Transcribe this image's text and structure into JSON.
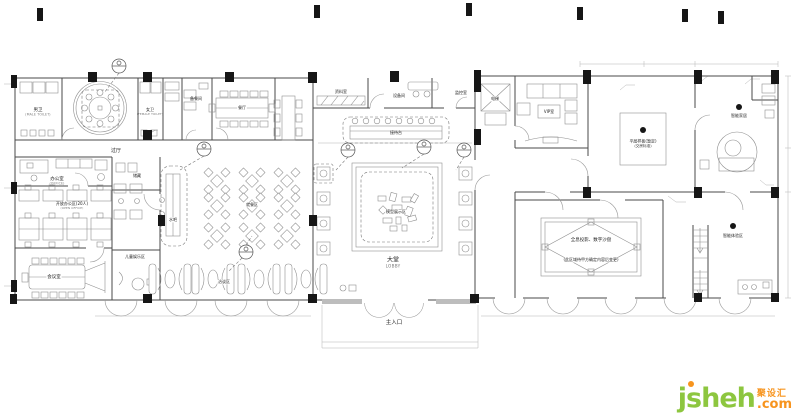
{
  "watermark": {
    "brand": "jsheh",
    "domain_suffix": ".com",
    "cn_name": "聚设汇",
    "green": "#8dc63f",
    "orange": "#f7941e"
  },
  "plan": {
    "rooms": {
      "male_toilet": {
        "zh": "男卫",
        "en": "(MALE TOILET)"
      },
      "female_toilet": {
        "zh": "女卫",
        "en": "(FEMALE TOILET)"
      },
      "pantry": {
        "zh": "备餐间"
      },
      "dining_room": {
        "zh": "餐厅"
      },
      "hall": {
        "zh": "过厅"
      },
      "office": {
        "zh": "办公室",
        "en": "(OFFICE)"
      },
      "open_office": {
        "zh": "开放办公区(20人)",
        "en": "(OPEN OFFICE)"
      },
      "meeting_room": {
        "zh": "会议室"
      },
      "storage": {
        "zh": "储藏"
      },
      "water_bar": {
        "zh": "水吧"
      },
      "kids_area": {
        "zh": "儿童娱乐区"
      },
      "dining_area": {
        "zh": "就餐区"
      },
      "booth_area": {
        "zh": "洽谈区"
      },
      "archive_room": {
        "zh": "资料室"
      },
      "equipment_room": {
        "zh": "设备间"
      },
      "monitor_room": {
        "zh": "监控室"
      },
      "elevator": {
        "zh": "电梯"
      },
      "vip_room": {
        "zh": "VIP室"
      },
      "reception_desk": {
        "zh": "接待台"
      },
      "model_display": {
        "zh": "模型展示区"
      },
      "lobby": {
        "zh": "大堂",
        "en": "LOBBY"
      },
      "main_entrance": {
        "zh": "主入口"
      },
      "model_flat": {
        "line1": "平层样板(暂定)",
        "line2": "(交房标准)"
      },
      "smart_home": {
        "zh": "智能家居"
      },
      "hologram": {
        "line1": "全息投影、数字沙盘",
        "line2": "(此区域待甲方确定内容后变更)"
      },
      "smart_experience": {
        "zh": "智能体验区"
      }
    }
  }
}
